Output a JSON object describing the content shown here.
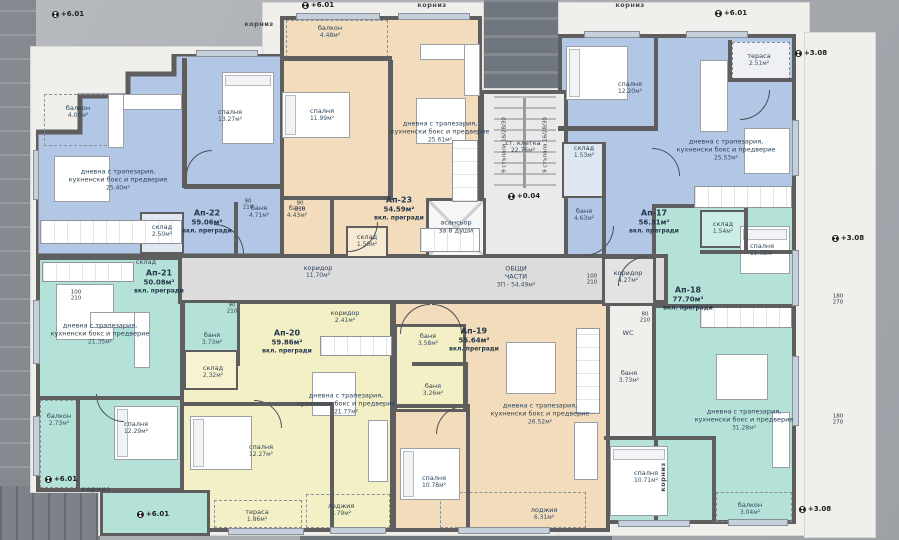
{
  "apartments": [
    {
      "id": "Ап-22",
      "area": "59.06м²",
      "note": "вкл. прегради",
      "x": 207,
      "y": 222
    },
    {
      "id": "Ап-23",
      "area": "54.59м²",
      "note": "вкл. прегради",
      "x": 399,
      "y": 209
    },
    {
      "id": "Ап-17",
      "area": "56.31м²",
      "note": "вкл. прегради",
      "x": 654,
      "y": 222
    },
    {
      "id": "Ап-18",
      "area": "77.70м²",
      "note": "вкл. прегради",
      "x": 688,
      "y": 299
    },
    {
      "id": "Ап-19",
      "area": "55.64м²",
      "note": "вкл. прегради",
      "x": 474,
      "y": 340
    },
    {
      "id": "Ап-20",
      "area": "59.86м²",
      "note": "вкл. прегради",
      "x": 287,
      "y": 342
    },
    {
      "id": "Ап-21",
      "area": "50.08м²",
      "note": "вкл. прегради",
      "x": 159,
      "y": 282
    }
  ],
  "rooms": [
    {
      "name": "балкон",
      "area": "4.06м²",
      "x": 78,
      "y": 112
    },
    {
      "name": "спалня",
      "area": "13.27м²",
      "x": 230,
      "y": 116
    },
    {
      "name": "дневна с трапезария,\nкухненски бокс и предверие",
      "area": "25.40м²",
      "x": 118,
      "y": 180
    },
    {
      "name": "баня",
      "area": "4.71м²",
      "x": 259,
      "y": 212
    },
    {
      "name": "склад",
      "area": "2.50м²",
      "x": 162,
      "y": 231
    },
    {
      "name": "балкон",
      "area": "4.48м²",
      "x": 330,
      "y": 32
    },
    {
      "name": "спалня",
      "area": "11.99м²",
      "x": 322,
      "y": 115
    },
    {
      "name": "дневна с трапезария,\nкухненски бокс и предверие",
      "area": "25.61м²",
      "x": 440,
      "y": 132
    },
    {
      "name": "баня",
      "area": "4.43м²",
      "x": 297,
      "y": 212
    },
    {
      "name": "склад",
      "area": "1.56м²",
      "x": 367,
      "y": 241
    },
    {
      "name": "тераса",
      "area": "2.51м²",
      "x": 759,
      "y": 60
    },
    {
      "name": "спалня",
      "area": "12.20м²",
      "x": 630,
      "y": 88
    },
    {
      "name": "дневна с трапезария,\nкухненски бокс и предверие",
      "area": "25.53м²",
      "x": 726,
      "y": 150
    },
    {
      "name": "склад",
      "area": "1.53м²",
      "x": 584,
      "y": 152
    },
    {
      "name": "баня",
      "area": "4.63м²",
      "x": 584,
      "y": 215
    },
    {
      "name": "склад",
      "area": "1.54м²",
      "x": 723,
      "y": 228
    },
    {
      "name": "спалня",
      "area": "11.02м²",
      "x": 762,
      "y": 250
    },
    {
      "name": "коридор",
      "area": "4.27м²",
      "x": 628,
      "y": 277
    },
    {
      "name": "WC",
      "area": "",
      "x": 628,
      "y": 333
    },
    {
      "name": "баня",
      "area": "3.73м²",
      "x": 629,
      "y": 377
    },
    {
      "name": "дневна с трапезария,\nкухненски бокс и предверие",
      "area": "31.28м²",
      "x": 744,
      "y": 420
    },
    {
      "name": "спалня",
      "area": "10.71м²",
      "x": 646,
      "y": 477
    },
    {
      "name": "балкон",
      "area": "3.04м²",
      "x": 750,
      "y": 509
    },
    {
      "name": "баня",
      "area": "3.26м²",
      "x": 433,
      "y": 390
    },
    {
      "name": "дневна с трапезария,\nкухненски бокс и предверие",
      "area": "26.52м²",
      "x": 540,
      "y": 414
    },
    {
      "name": "спалня",
      "area": "10.78м²",
      "x": 434,
      "y": 482
    },
    {
      "name": "лоджия",
      "area": "6.31м²",
      "x": 544,
      "y": 514
    },
    {
      "name": "коридор",
      "area": "2.41м²",
      "x": 345,
      "y": 317
    },
    {
      "name": "баня",
      "area": "3.58м²",
      "x": 428,
      "y": 340
    },
    {
      "name": "склад",
      "area": "2.32м²",
      "x": 213,
      "y": 372
    },
    {
      "name": "спалня",
      "area": "12.27м²",
      "x": 261,
      "y": 451
    },
    {
      "name": "дневна с трапезария,\nкухненски бокс и предверие",
      "area": "21.77м²",
      "x": 346,
      "y": 404
    },
    {
      "name": "тераса",
      "area": "1.86м²",
      "x": 257,
      "y": 516
    },
    {
      "name": "лоджия",
      "area": "3.79м²",
      "x": 341,
      "y": 510
    },
    {
      "name": "склад",
      "area": "",
      "x": 146,
      "y": 262
    },
    {
      "name": "дневна с трапезария,\nкухненски бокс и предверие",
      "area": "21.35м²",
      "x": 100,
      "y": 334
    },
    {
      "name": "балкон",
      "area": "2.73м²",
      "x": 59,
      "y": 420
    },
    {
      "name": "спалня",
      "area": "12.29м²",
      "x": 136,
      "y": 428
    },
    {
      "name": "баня",
      "area": "3.73м²",
      "x": 212,
      "y": 339
    },
    {
      "name": "коридор",
      "area": "11.70м²",
      "x": 318,
      "y": 272
    },
    {
      "name": "асансьор\nза 8 души",
      "area": "",
      "x": 456,
      "y": 227
    },
    {
      "name": "ст. клетка",
      "area": "22.76м²",
      "x": 523,
      "y": 147
    },
    {
      "name": "ОБЩИ\nЧАСТИ",
      "area": "ЗП - 54.49м²",
      "x": 516,
      "y": 277
    }
  ],
  "elevations": [
    {
      "text": "+6.01",
      "x": 68,
      "y": 14
    },
    {
      "text": "+6.01",
      "x": 318,
      "y": 5
    },
    {
      "text": "+6.01",
      "x": 731,
      "y": 13
    },
    {
      "text": "+3.08",
      "x": 811,
      "y": 53
    },
    {
      "text": "+3.08",
      "x": 848,
      "y": 238
    },
    {
      "text": "+3.08",
      "x": 815,
      "y": 509
    },
    {
      "text": "+6.01",
      "x": 61,
      "y": 479
    },
    {
      "text": "+6.01",
      "x": 153,
      "y": 514
    },
    {
      "text": "+0.04",
      "x": 524,
      "y": 196
    }
  ],
  "cornice_labels": [
    {
      "text": "корниз",
      "x": 259,
      "y": 24,
      "vertical": false
    },
    {
      "text": "корниз",
      "x": 432,
      "y": 5,
      "vertical": false
    },
    {
      "text": "корниз",
      "x": 630,
      "y": 5,
      "vertical": false
    },
    {
      "text": "корниз",
      "x": 96,
      "y": 489,
      "vertical": false
    },
    {
      "text": "корниз",
      "x": 663,
      "y": 477,
      "vertical": true
    }
  ],
  "dims": [
    {
      "a": "90",
      "b": "210",
      "x": 248,
      "y": 205
    },
    {
      "a": "90",
      "b": "210",
      "x": 300,
      "y": 207
    },
    {
      "a": "100",
      "b": "210",
      "x": 76,
      "y": 296
    },
    {
      "a": "100",
      "b": "210",
      "x": 592,
      "y": 280
    },
    {
      "a": "90",
      "b": "210",
      "x": 232,
      "y": 309
    },
    {
      "a": "80",
      "b": "210",
      "x": 645,
      "y": 318
    },
    {
      "a": "180",
      "b": "270",
      "x": 838,
      "y": 300
    },
    {
      "a": "180",
      "b": "270",
      "x": 838,
      "y": 420
    }
  ],
  "stair_notes": [
    {
      "text": "9 стъпала 16/28/30",
      "x": 505,
      "y": 145
    },
    {
      "text": "9 стъпала 16/28/30",
      "x": 546,
      "y": 145
    }
  ],
  "colors": {
    "blue_apartment": "#b2c6e6",
    "beige_apartment": "#f3dcbb",
    "teal_apartment": "#b5e2d8",
    "yellow_apartment": "#f4f0c6",
    "corridor_gray": "#dcdcdc",
    "wall_gray": "#5e5e5e"
  }
}
